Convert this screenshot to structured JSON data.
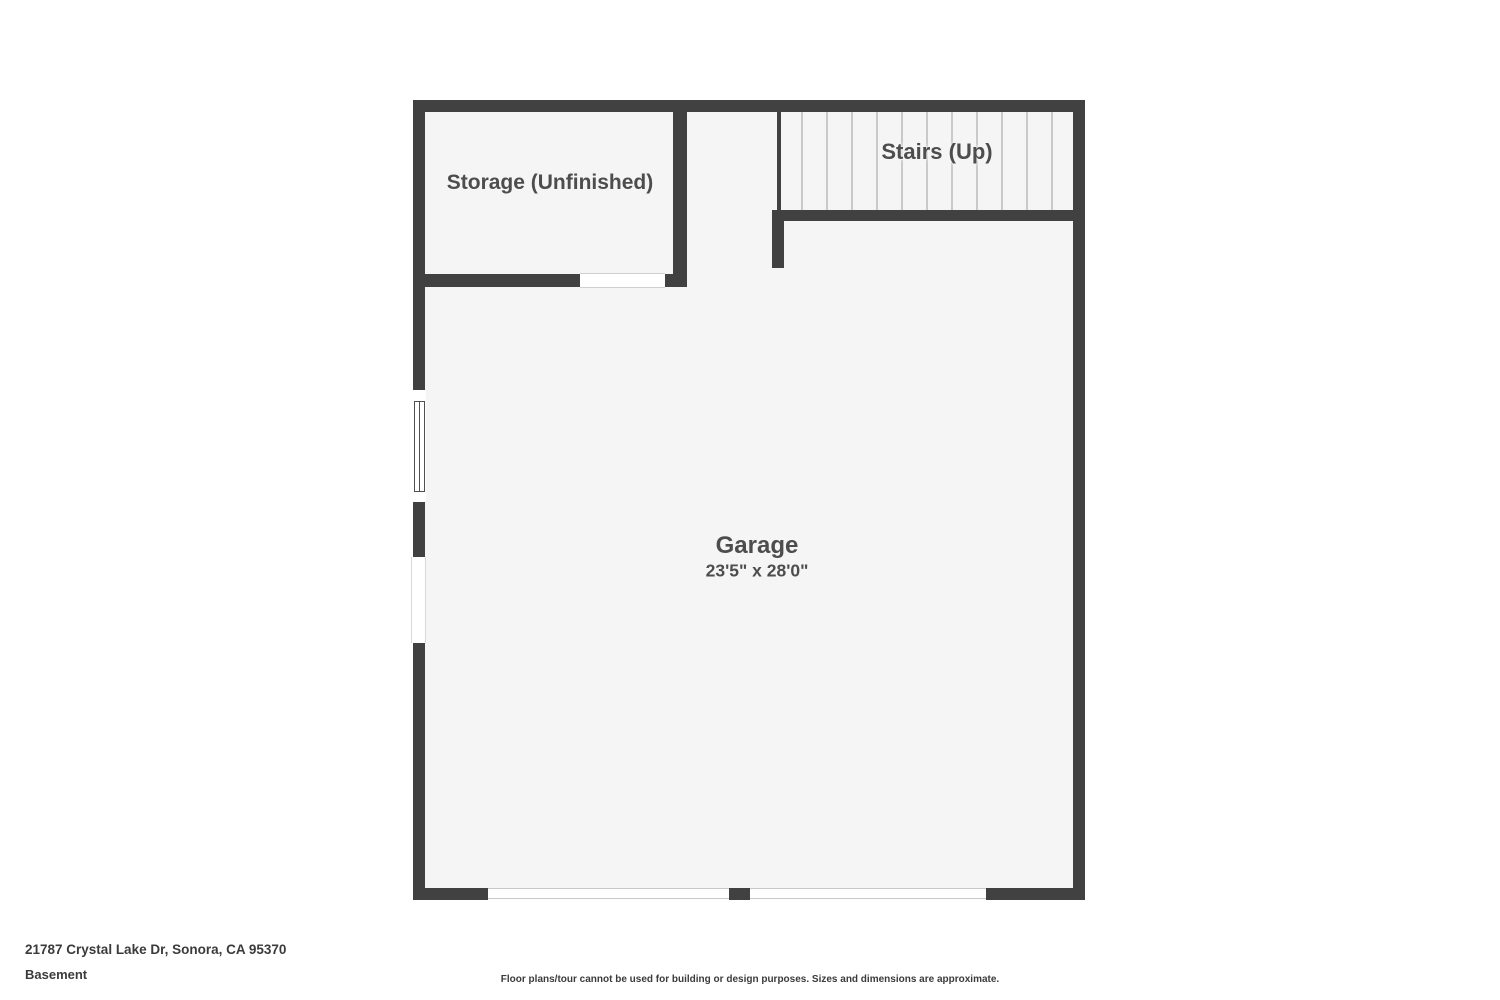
{
  "floorplan": {
    "level_name": "Basement",
    "rooms": [
      {
        "id": "storage",
        "label": "Storage (Unfinished)"
      },
      {
        "id": "stairs",
        "label": "Stairs (Up)"
      },
      {
        "id": "garage",
        "label": "Garage",
        "dimensions": "23'5\" x 28'0\""
      }
    ],
    "stairs": {
      "tread_count": 11,
      "tread_start_x": 801,
      "tread_spacing": 25,
      "tread_top": 112,
      "tread_height": 98
    },
    "colors": {
      "wall": "#414141",
      "floor": "#f5f5f5",
      "tread": "#c9c9c9",
      "label": "#4d4d4d"
    }
  },
  "footer": {
    "address": "21787 Crystal Lake Dr, Sonora, CA 95370",
    "level": "Basement",
    "disclaimer": "Floor plans/tour cannot be used for building or design purposes. Sizes and dimensions are approximate."
  }
}
